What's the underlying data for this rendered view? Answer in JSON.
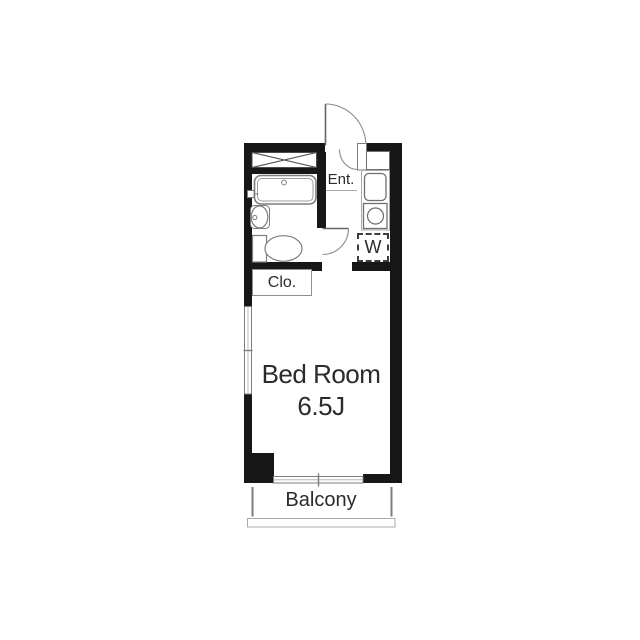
{
  "labels": {
    "entrance": "Ent.",
    "washer": "W",
    "closet": "Clo.",
    "bedroom_name": "Bed Room",
    "bedroom_size": "6.5J",
    "balcony": "Balcony"
  },
  "colors": {
    "background": "#ffffff",
    "wall": "#171717",
    "fixture": "#7d7d7d",
    "door": "#666666",
    "text": "#2b2b2b"
  }
}
